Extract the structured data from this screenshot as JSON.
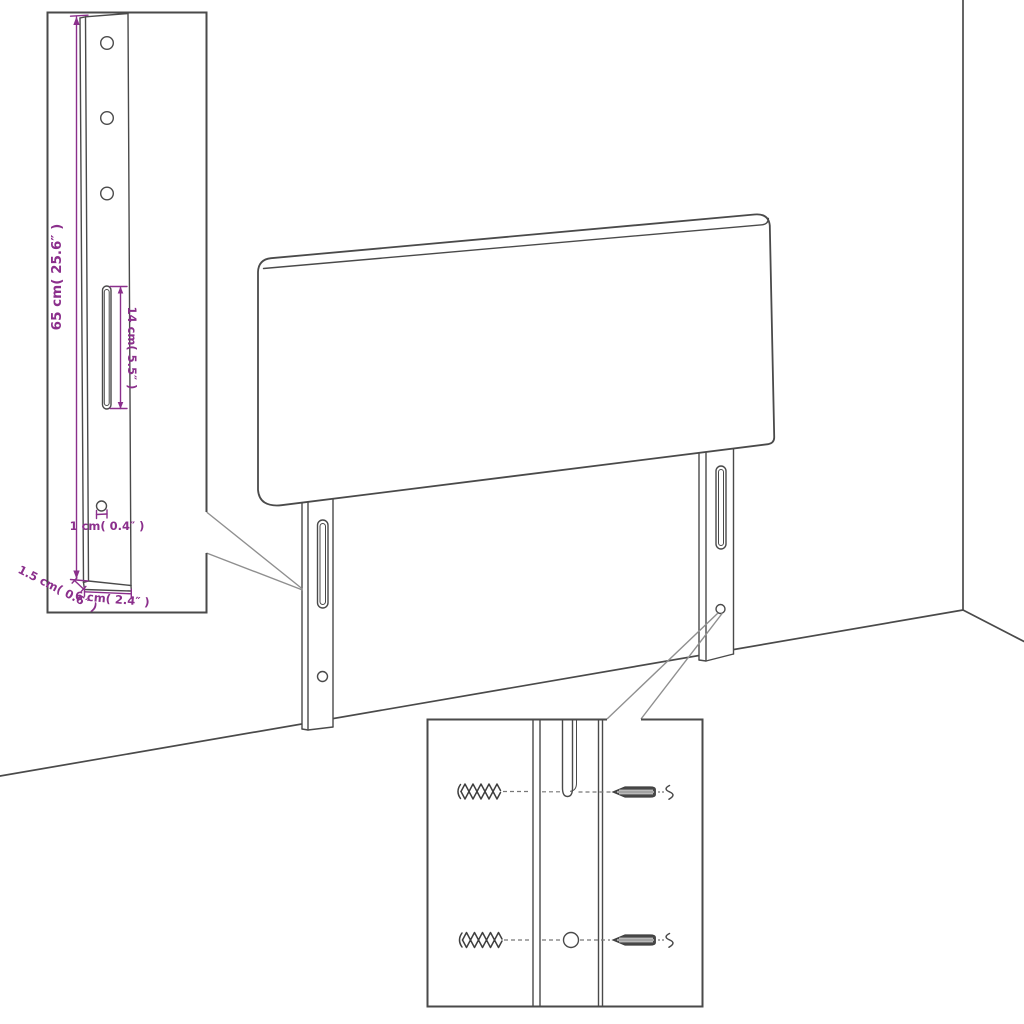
{
  "colors": {
    "outline": "#4a4a4a",
    "leader": "#8f8f8f",
    "dimension": "#8b2f8c",
    "dash": "#777777",
    "background": "#ffffff"
  },
  "drawing": {
    "type": "furniture-assembly-diagram",
    "subject": "headboard with two mounting legs in room corner",
    "views": [
      "main-perspective",
      "leg-dimension-detail",
      "wall-mounting-detail"
    ]
  },
  "leg_detail": {
    "dimensions": {
      "height": "65 cm( 25.6″ )",
      "slot_length": "14 cm( 5.5″ )",
      "hole_diameter": "1 cm( 0.4″ )",
      "depth": "1.5 cm( 0.6″ )",
      "width": "6 cm( 2.4″ )"
    }
  },
  "mounting_detail": {
    "hardware": [
      "wall-plug",
      "wall-plug",
      "screw",
      "screw"
    ]
  }
}
